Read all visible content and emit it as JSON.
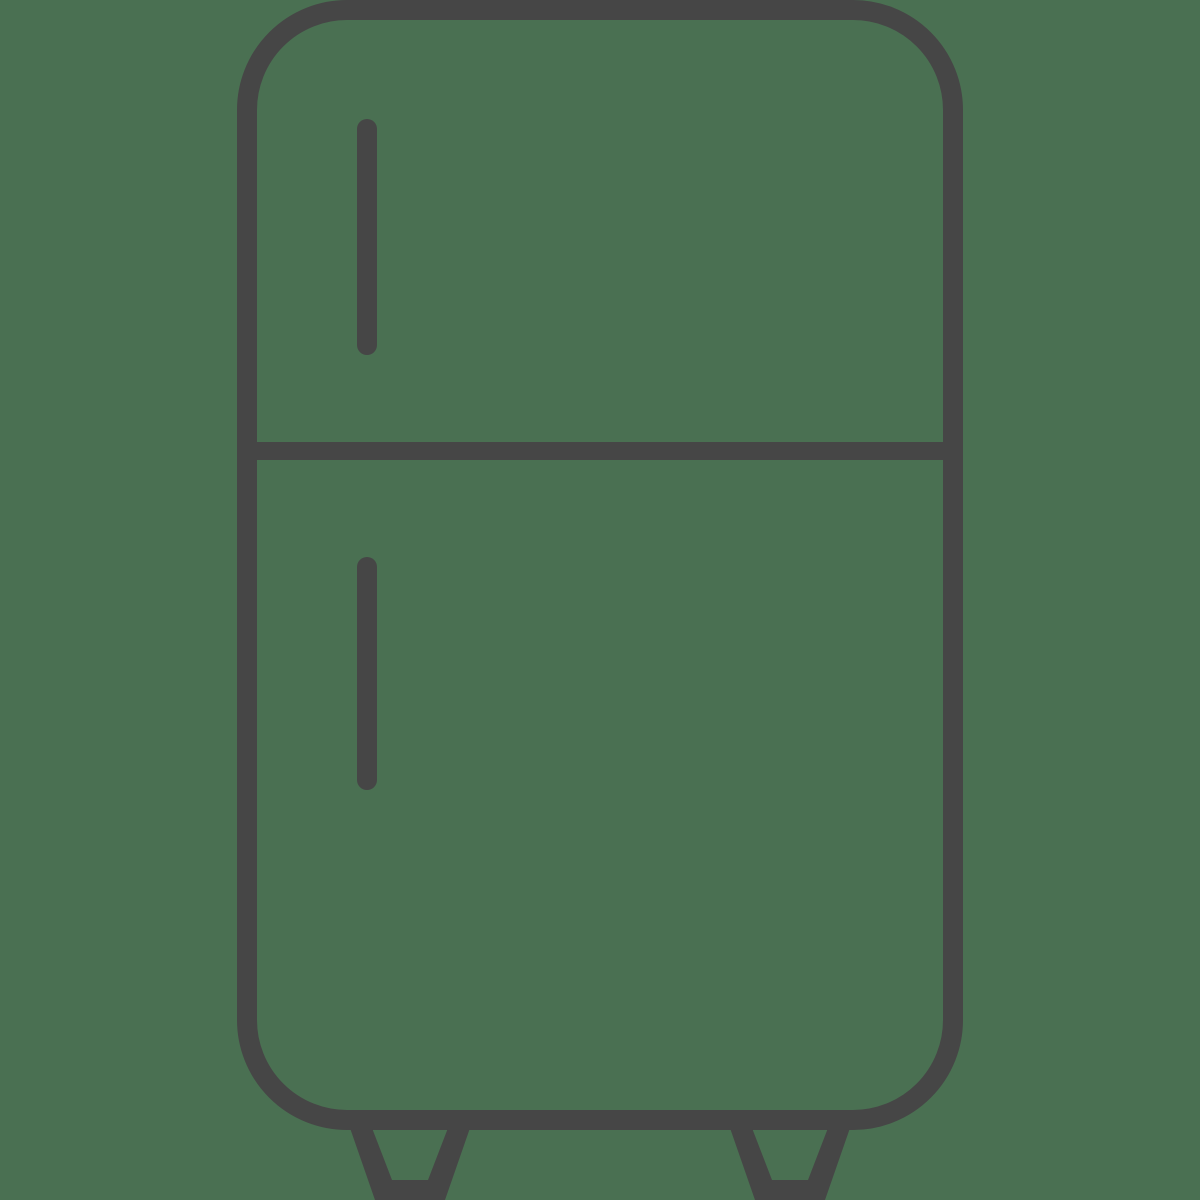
{
  "icon": {
    "name": "refrigerator-icon",
    "alt": "Refrigerator outline icon with freezer door, fridge door, two handles and two feet",
    "style": "line-art outline",
    "parts": [
      "fridge-body-outline",
      "door-divider",
      "freezer-door-handle",
      "fridge-door-handle",
      "left-foot",
      "right-foot"
    ]
  },
  "colors": {
    "background": "#4a7052",
    "stroke": "#464646"
  }
}
